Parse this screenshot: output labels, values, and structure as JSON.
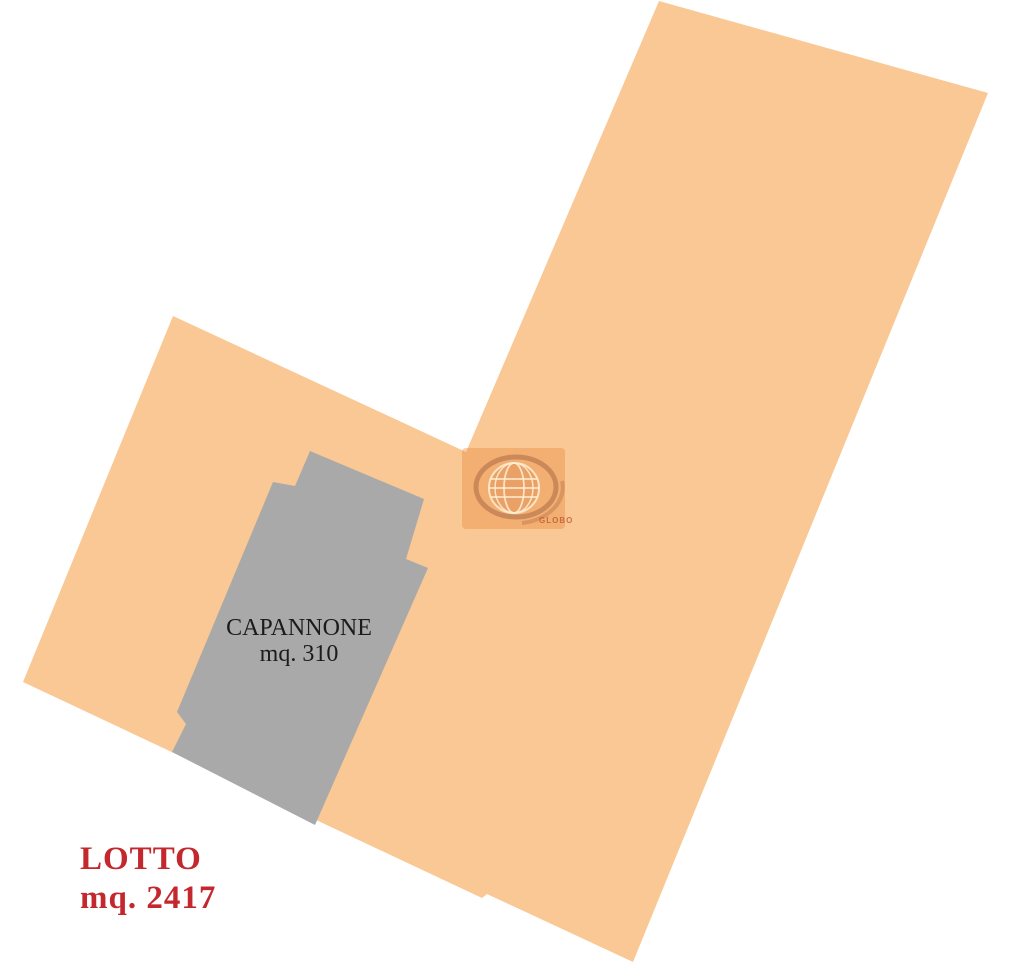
{
  "palette": {
    "background": "#ffffff",
    "lot_fill": "#F9C894",
    "building_fill": "#A9A9A9",
    "lot_label_color": "#C3282E",
    "building_label_color": "#1B1B1B",
    "watermark_tint": "rgba(236,140,66,0.42)",
    "watermark_ring": "rgba(140,75,50,0.38)",
    "watermark_swoosh": "rgba(160,85,55,0.30)",
    "watermark_line": "rgba(255,238,210,0.85)",
    "watermark_globe_fill": "rgba(190,100,55,0.18)",
    "watermark_text_color": "rgba(186,84,48,0.75)"
  },
  "lot": {
    "name": "LOTTO",
    "area_label": "mq. 2417",
    "area_mq": "2417"
  },
  "building": {
    "name": "CAPANNONE",
    "area_label": "mq. 310",
    "area_mq": "310"
  },
  "watermark": {
    "label": "GLOBO"
  },
  "geometry": {
    "lot_points": "659,1 988,93 633,962 487,894 482,898 23,682 173,316 466,452",
    "building_points": "310,451 424,499 406,559 428,568 315,825 172,752 186,724 177,712 273,482 295,486"
  }
}
